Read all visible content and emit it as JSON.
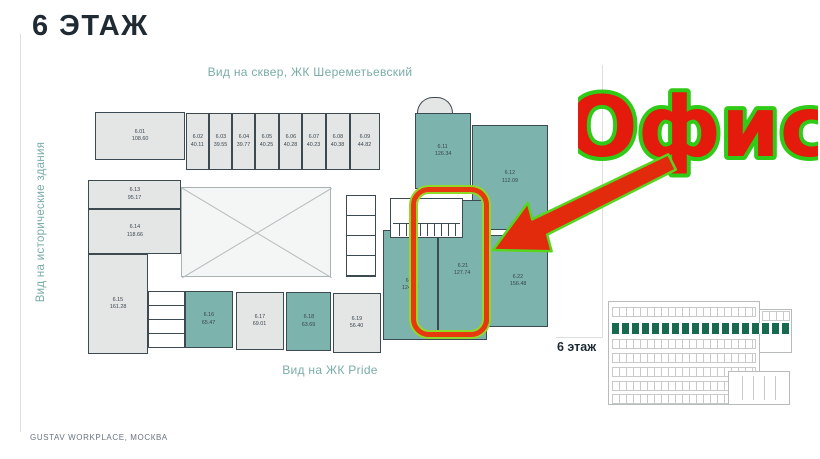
{
  "page": {
    "title": "6 ЭТАЖ",
    "footer": "GUSTAV WORKPLACE, МОСКВА"
  },
  "plan": {
    "view_labels": {
      "top": "Вид на сквер, ЖК Шереметьевский",
      "left": "Вид на исторические здания",
      "bottom": "Вид на ЖК Pride"
    },
    "rooms": [
      {
        "number": "6.01",
        "area": "108.60",
        "tone": "gray"
      },
      {
        "number": "6.02",
        "area": "40.11",
        "tone": "gray"
      },
      {
        "number": "6.03",
        "area": "39.55",
        "tone": "gray"
      },
      {
        "number": "6.04",
        "area": "39.77",
        "tone": "gray"
      },
      {
        "number": "6.05",
        "area": "40.25",
        "tone": "gray"
      },
      {
        "number": "6.06",
        "area": "40.28",
        "tone": "gray"
      },
      {
        "number": "6.07",
        "area": "40.23",
        "tone": "gray"
      },
      {
        "number": "6.08",
        "area": "40.38",
        "tone": "gray"
      },
      {
        "number": "6.09",
        "area": "44.82",
        "tone": "gray"
      },
      {
        "number": "6.11",
        "area": "126.34",
        "tone": "teal"
      },
      {
        "number": "6.12",
        "area": "112.09",
        "tone": "teal"
      },
      {
        "number": "6.13",
        "area": "95.17",
        "tone": "gray"
      },
      {
        "number": "6.14",
        "area": "118.66",
        "tone": "gray"
      },
      {
        "number": "6.15",
        "area": "161.28",
        "tone": "gray"
      },
      {
        "number": "6.16",
        "area": "65.47",
        "tone": "teal"
      },
      {
        "number": "6.17",
        "area": "69.01",
        "tone": "gray"
      },
      {
        "number": "6.18",
        "area": "63.69",
        "tone": "teal"
      },
      {
        "number": "6.19",
        "area": "56.40",
        "tone": "gray"
      },
      {
        "number": "6.20",
        "area": "124.29",
        "tone": "teal"
      },
      {
        "number": "6.21",
        "area": "127.74",
        "tone": "teal"
      },
      {
        "number": "6.22",
        "area": "156.48",
        "tone": "teal"
      }
    ],
    "colors": {
      "teal_room": "#7cb3ac",
      "gray_room": "#e4e6e5",
      "wall": "#3e4a52"
    }
  },
  "annotation": {
    "office_label": "Офис",
    "text_color": "#e41a0c",
    "outline_color": "#2fcb17",
    "highlight_border": "#e8380d",
    "highlight_outline": "#8fd929"
  },
  "elevation": {
    "floor_label": "6 этаж",
    "highlight_color": "#17694f"
  }
}
